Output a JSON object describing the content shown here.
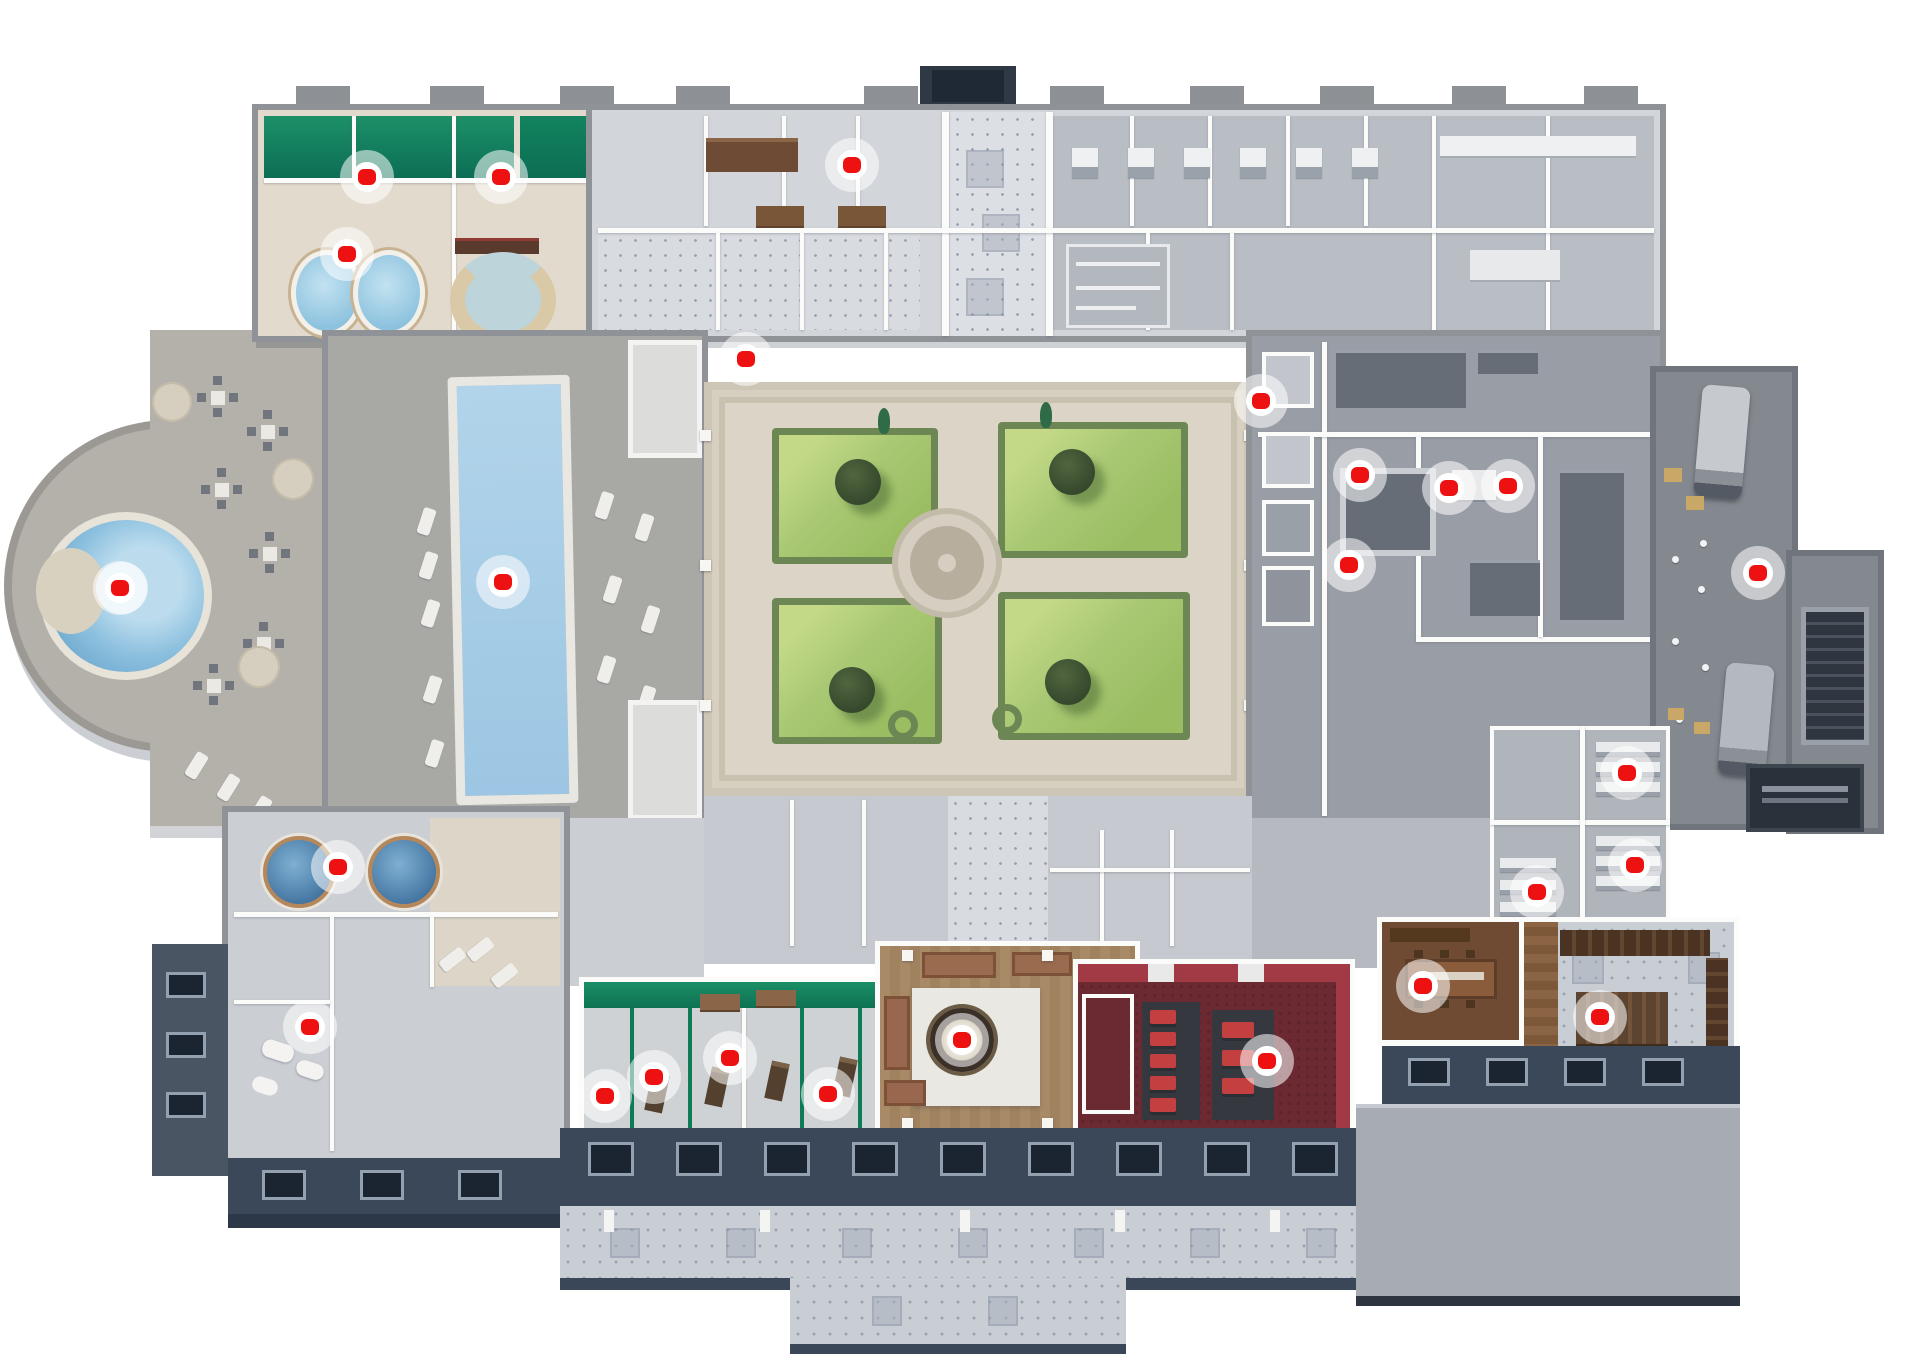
{
  "page": {
    "type": "interactive-3d-floorplan",
    "description": "isometric hotel spa floor plan with clickable hotspots",
    "canvas": {
      "width": 1920,
      "height": 1357
    },
    "background": "#ffffff",
    "hotspot_count": 26
  },
  "palette": {
    "marker_red": "#ee1111",
    "marker_ring": "#ffffff",
    "marker_halo": "rgba(255,255,255,0.55)",
    "pool_water": "#a6cde7",
    "round_pool_water": "#6ca6cd",
    "hot_tub_water": "#a9d4ea",
    "cold_tub_water": "#41729f",
    "spa_wall_green": "#15885f",
    "garden_green": "#a9c873",
    "hedge_green": "#6d8754",
    "tree_green": "#36492d",
    "courtyard_beige": "#dcd4c6",
    "deck_gray": "#b4b1ab",
    "pool_hall_gray": "#a8a8a5",
    "room_gray": "#d2d5d9",
    "service_gray": "#999da5",
    "dock_gray": "#84888f",
    "outer_wall_gray": "#8f9398",
    "facade_slate": "#3b4859",
    "cinema_floor": "#6b2a32",
    "cinema_wall": "#a23a45",
    "cinema_seat": "#c43f3f",
    "lounge_floor": "#a88a67",
    "dining_floor": "#6f4b34",
    "wood_shelf": "#4a3323",
    "terrace_tile": "#c9cdd4"
  },
  "markers": [
    {
      "id": 1,
      "x": 367,
      "y": 177,
      "area": "treatment-room-a"
    },
    {
      "id": 2,
      "x": 501,
      "y": 177,
      "area": "treatment-room-b"
    },
    {
      "id": 3,
      "x": 347,
      "y": 254,
      "area": "hot-tub-room"
    },
    {
      "id": 4,
      "x": 852,
      "y": 165,
      "area": "north-room"
    },
    {
      "id": 5,
      "x": 746,
      "y": 359,
      "area": "corridor-room"
    },
    {
      "id": 6,
      "x": 503,
      "y": 582,
      "area": "indoor-pool"
    },
    {
      "id": 7,
      "x": 120,
      "y": 588,
      "area": "outdoor-round-pool"
    },
    {
      "id": 8,
      "x": 1261,
      "y": 401,
      "area": "service-corridor"
    },
    {
      "id": 9,
      "x": 1360,
      "y": 475,
      "area": "kitchen-a"
    },
    {
      "id": 10,
      "x": 1449,
      "y": 488,
      "area": "kitchen-b"
    },
    {
      "id": 11,
      "x": 1508,
      "y": 486,
      "area": "kitchen-c"
    },
    {
      "id": 12,
      "x": 1349,
      "y": 565,
      "area": "kitchen-d"
    },
    {
      "id": 13,
      "x": 1758,
      "y": 573,
      "area": "loading-dock"
    },
    {
      "id": 14,
      "x": 1627,
      "y": 773,
      "area": "storeroom-a"
    },
    {
      "id": 15,
      "x": 1635,
      "y": 865,
      "area": "storeroom-b"
    },
    {
      "id": 16,
      "x": 1537,
      "y": 892,
      "area": "storeroom-c"
    },
    {
      "id": 17,
      "x": 338,
      "y": 867,
      "area": "plunge-tubs"
    },
    {
      "id": 18,
      "x": 310,
      "y": 1027,
      "area": "washroom"
    },
    {
      "id": 19,
      "x": 605,
      "y": 1096,
      "area": "treatment-cabin-1"
    },
    {
      "id": 20,
      "x": 654,
      "y": 1077,
      "area": "treatment-cabin-2"
    },
    {
      "id": 21,
      "x": 730,
      "y": 1058,
      "area": "treatment-cabin-3"
    },
    {
      "id": 22,
      "x": 828,
      "y": 1094,
      "area": "treatment-cabin-4"
    },
    {
      "id": 23,
      "x": 962,
      "y": 1040,
      "area": "lounge"
    },
    {
      "id": 24,
      "x": 1267,
      "y": 1061,
      "area": "cinema"
    },
    {
      "id": 25,
      "x": 1423,
      "y": 986,
      "area": "dining-room"
    },
    {
      "id": 26,
      "x": 1600,
      "y": 1017,
      "area": "bar-library"
    }
  ]
}
